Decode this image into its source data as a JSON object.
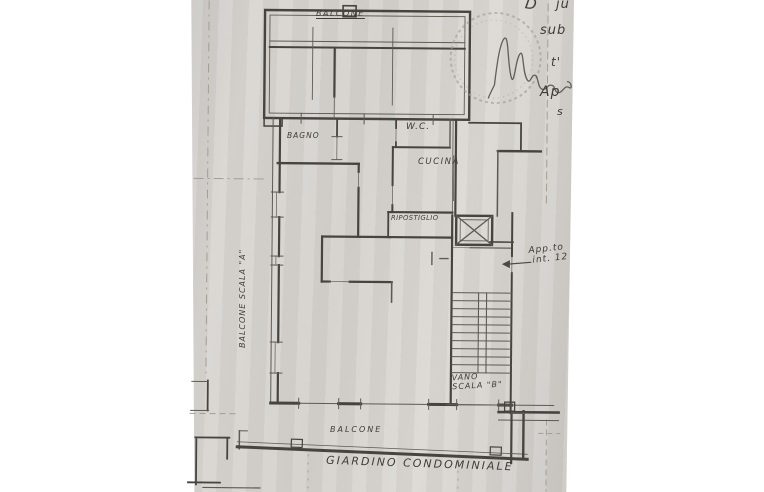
{
  "document": {
    "kind": "scanned-floor-plan-photo",
    "language": "it"
  },
  "colors": {
    "background": "#ffffff",
    "paper": "#d7d4d0",
    "ink": "#47443f",
    "faint_lines": "#a29e96"
  },
  "plan": {
    "rooms": {
      "balcone_top": "BALCONE",
      "bagno": "BAGNO",
      "wc": "W.C.",
      "cucina": "CUCINA",
      "ripostiglio": "RIPOSTIGLIO",
      "balcone_bottom": "BALCONE"
    },
    "areas": {
      "vano_scala_b_line1": "VANO",
      "vano_scala_b_line2": "SCALA \"B\"",
      "scala_a_side_label": "BALCONE SCALA \"A\"",
      "giardino": "GIARDINO CONDOMINIALE"
    },
    "annotations": {
      "apartment_ref_line1": "App.to",
      "apartment_ref_line2": "int. 12",
      "fragments": [
        "D",
        "ju",
        "sub",
        "t'",
        "Ap",
        "s"
      ]
    },
    "symbols": {
      "elevator": "elevator-shaft-x",
      "stairs": "staircase-treads",
      "stamp": "round-embossed-stamp",
      "signature": "handwritten-signature"
    }
  }
}
